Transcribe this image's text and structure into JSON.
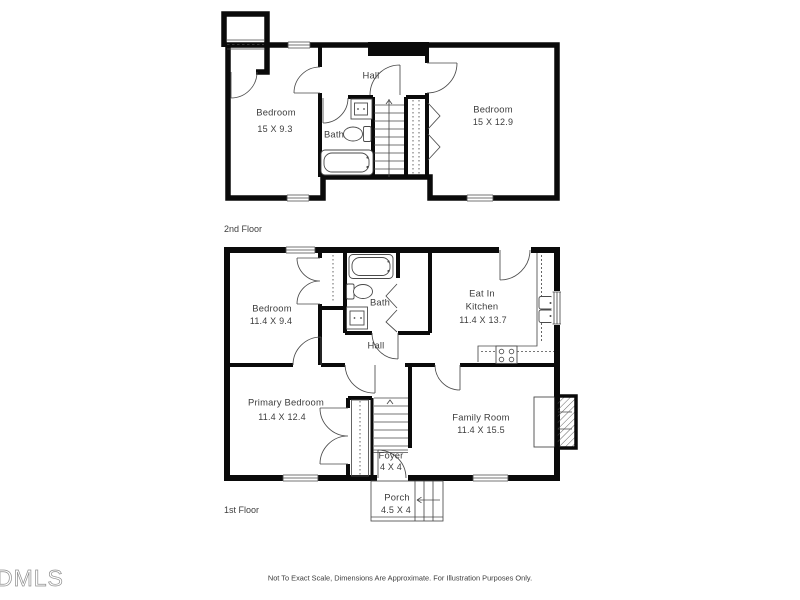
{
  "floors": {
    "second": {
      "label": "2nd Floor",
      "bedroom_left": {
        "name": "Bedroom",
        "dims": "15 X 9.3"
      },
      "bedroom_right": {
        "name": "Bedroom",
        "dims": "15 X 12.9"
      },
      "bath": {
        "name": "Bath"
      },
      "hall": {
        "name": "Hall"
      }
    },
    "first": {
      "label": "1st Floor",
      "bedroom": {
        "name": "Bedroom",
        "dims": "11.4 X 9.4"
      },
      "bath": {
        "name": "Bath"
      },
      "kitchen": {
        "name_line1": "Eat In",
        "name_line2": "Kitchen",
        "dims": "11.4 X 13.7"
      },
      "hall": {
        "name": "Hall"
      },
      "primary_bedroom": {
        "name": "Primary Bedroom",
        "dims": "11.4 X 12.4"
      },
      "family_room": {
        "name": "Family Room",
        "dims": "11.4 X 15.5"
      },
      "foyer": {
        "name": "Foyer",
        "dims": "4 X 4"
      },
      "porch": {
        "name": "Porch",
        "dims": "4.5 X 4"
      }
    }
  },
  "footer": {
    "disclaimer": "Not To Exact Scale, Dimensions Are Approximate. For Illustration Purposes Only.",
    "logo": "DMLS"
  },
  "colors": {
    "wall": "#0a0a0a",
    "line": "#4a4a4a",
    "text": "#3d3d3d",
    "logo": "#8f8f8f",
    "background": "#ffffff"
  }
}
